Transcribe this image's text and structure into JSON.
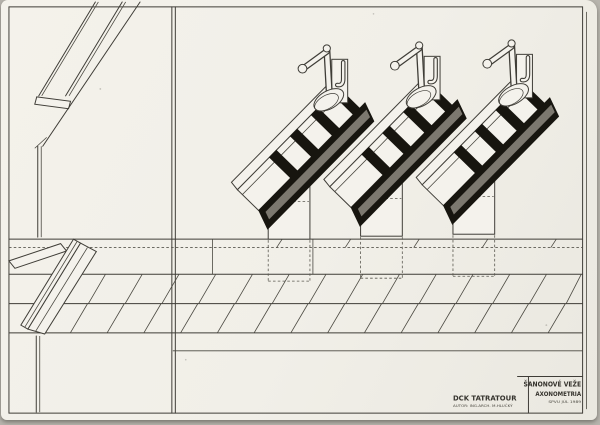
{
  "title_block": {
    "company": "DCK TATRATOUR",
    "author_line": "AUTOR: ING.ARCH. M.HLUČKÝ",
    "drawing_title": "ŠANONOVÉ VEŽE",
    "drawing_subtitle": "AXONOMETRIA",
    "date_line": "SPVU JÚL 1989"
  },
  "drawing": {
    "description": "Axonometric ink drawing: three tilted black shelf towers with spotlights mounted on pedestals above a long hatched counter",
    "tower_count": "3"
  },
  "colors": {
    "paper": "#f2f0e9",
    "ink": "#3f3d37",
    "solid_fill": "#17150f",
    "stripe": "#8e8a80",
    "photo_background": "#b7b4ad"
  }
}
